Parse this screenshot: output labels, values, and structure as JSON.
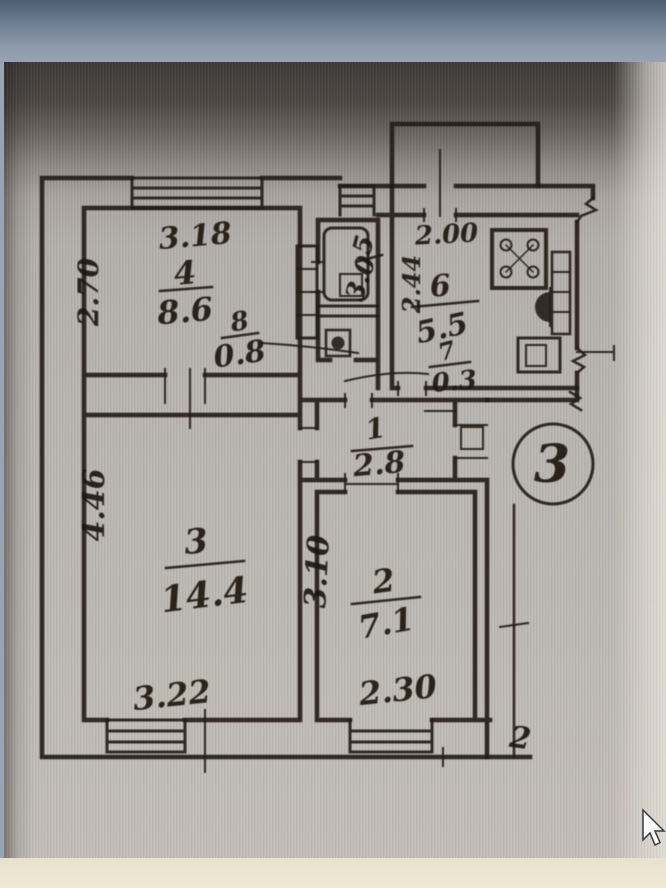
{
  "plan": {
    "apartment_circle_number": "3",
    "corner_mark": "2",
    "rooms": {
      "room4": {
        "number": "4",
        "area": "8.6",
        "dim_top": "3.18",
        "dim_left": "2.70"
      },
      "closet8": {
        "number": "8",
        "area": "0.8"
      },
      "bath5": {
        "number": "5",
        "area": "3.0"
      },
      "kitchen6": {
        "number": "6",
        "area": "5.5",
        "dim_top": "2.00",
        "dim_left": "2.44"
      },
      "toilet7": {
        "number": "7",
        "area": "0.3"
      },
      "hall1": {
        "number": "1",
        "area": "2.8"
      },
      "living3": {
        "number": "3",
        "area": "14.4",
        "dim_left": "4.46",
        "dim_bottom": "3.22"
      },
      "room2": {
        "number": "2",
        "area": "7.1",
        "dim_left": "3.10",
        "dim_bottom": "2.30"
      }
    }
  }
}
